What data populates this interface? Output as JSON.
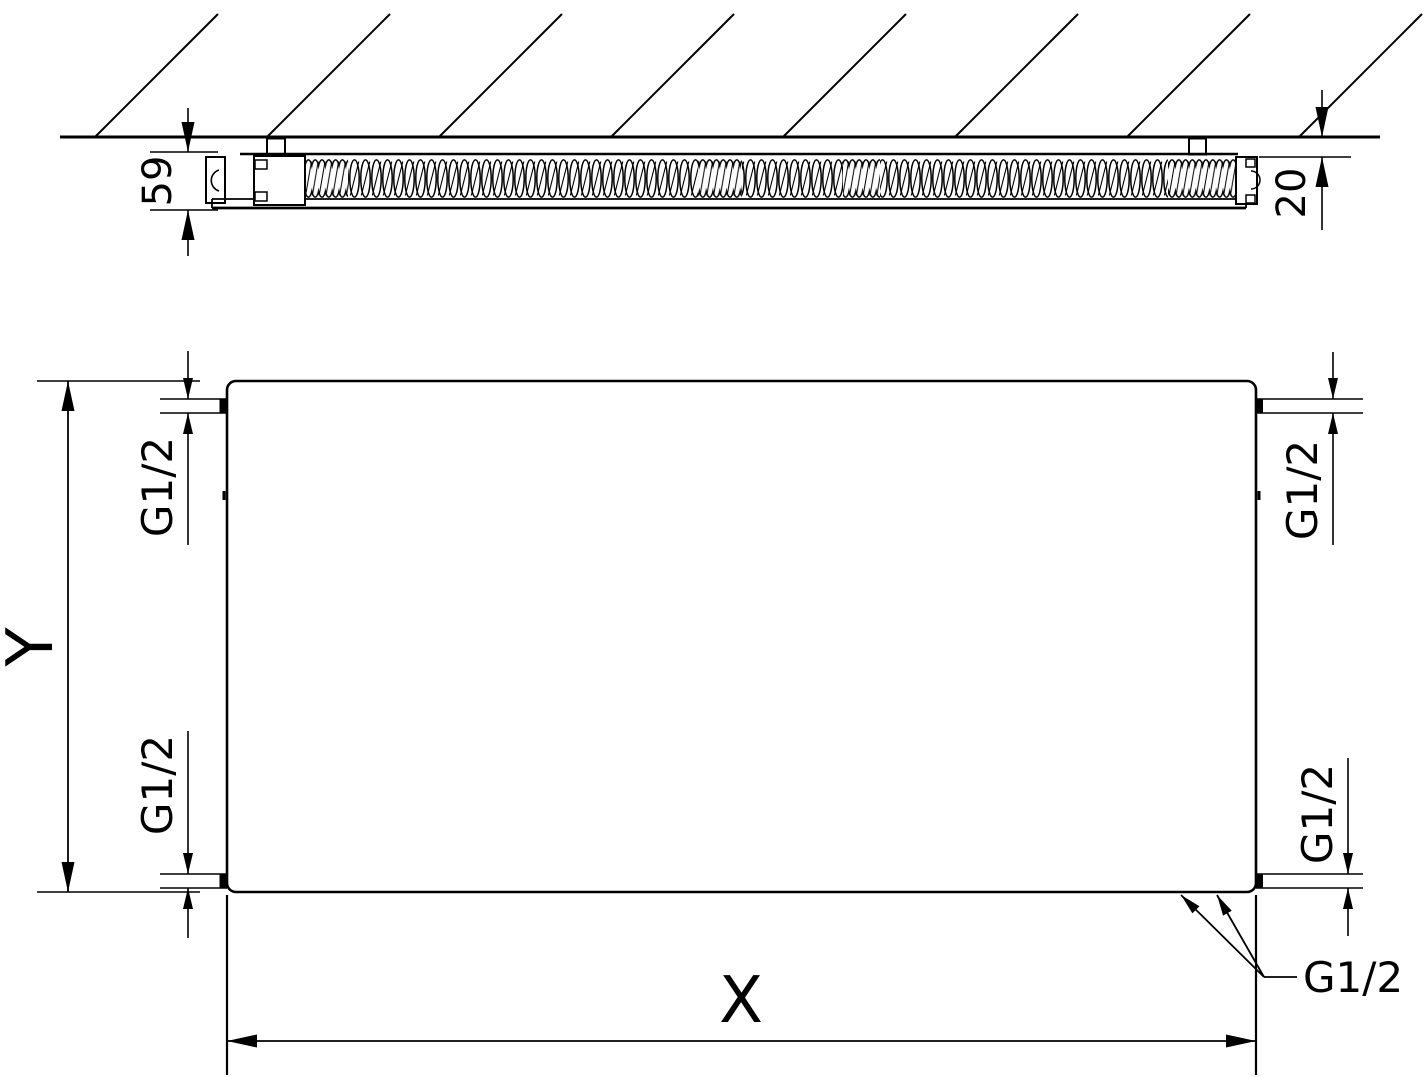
{
  "section_view": {
    "depth_dimension": "59",
    "wall_clearance_dimension": "20"
  },
  "front_view": {
    "width_dimension_label": "X",
    "height_dimension_label": "Y",
    "thread_labels": {
      "top_left": "G1/2",
      "top_right": "G1/2",
      "bottom_left": "G1/2",
      "bottom_right": "G1/2",
      "bottom_connections": "G1/2"
    }
  },
  "colors": {
    "line": "#000000",
    "background": "#ffffff"
  }
}
